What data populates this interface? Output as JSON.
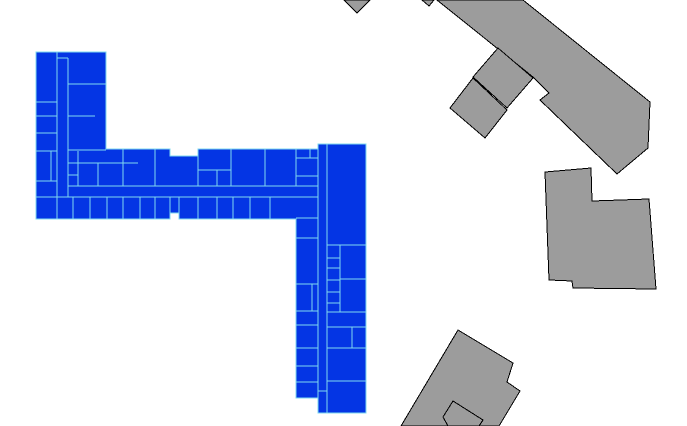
{
  "canvas": {
    "width": 687,
    "height": 426,
    "background": "#ffffff"
  },
  "selected_building": {
    "name": "selected-building",
    "fill": "#0435e4",
    "wall_color": "#7fd9ef",
    "wall_width": 1.3,
    "outline": [
      [
        36,
        52
      ],
      [
        106,
        52
      ],
      [
        106,
        149
      ],
      [
        170,
        149
      ],
      [
        170,
        156
      ],
      [
        198,
        156
      ],
      [
        198,
        149
      ],
      [
        318,
        149
      ],
      [
        318,
        144
      ],
      [
        366,
        144
      ],
      [
        366,
        413
      ],
      [
        318,
        413
      ],
      [
        318,
        398
      ],
      [
        296,
        398
      ],
      [
        296,
        219
      ],
      [
        179,
        219
      ],
      [
        179,
        213
      ],
      [
        170,
        213
      ],
      [
        170,
        219
      ],
      [
        36,
        219
      ]
    ],
    "walls": [
      [
        57,
        52,
        57,
        219
      ],
      [
        68,
        58,
        68,
        197
      ],
      [
        57,
        58,
        68,
        58
      ],
      [
        68,
        84,
        106,
        84
      ],
      [
        68,
        116,
        95,
        116
      ],
      [
        68,
        150,
        106,
        150
      ],
      [
        36,
        102,
        57,
        102
      ],
      [
        36,
        116,
        57,
        116
      ],
      [
        36,
        133,
        57,
        133
      ],
      [
        36,
        151,
        57,
        151
      ],
      [
        51,
        151,
        51,
        181
      ],
      [
        36,
        181,
        57,
        181
      ],
      [
        78,
        151,
        78,
        186
      ],
      [
        68,
        163,
        78,
        163
      ],
      [
        68,
        175,
        78,
        175
      ],
      [
        78,
        163,
        138,
        163
      ],
      [
        98,
        163,
        98,
        186
      ],
      [
        123,
        149,
        123,
        186
      ],
      [
        155,
        149,
        155,
        186
      ],
      [
        198,
        156,
        198,
        186
      ],
      [
        198,
        170,
        231,
        170
      ],
      [
        217,
        170,
        217,
        186
      ],
      [
        231,
        149,
        231,
        186
      ],
      [
        265,
        149,
        265,
        186
      ],
      [
        296,
        149,
        296,
        186
      ],
      [
        296,
        158,
        318,
        158
      ],
      [
        310,
        149,
        310,
        158
      ],
      [
        296,
        176,
        318,
        176
      ],
      [
        68,
        186,
        318,
        186
      ],
      [
        36,
        197,
        318,
        197
      ],
      [
        73,
        197,
        73,
        219
      ],
      [
        90,
        197,
        90,
        219
      ],
      [
        107,
        197,
        107,
        219
      ],
      [
        123,
        197,
        123,
        219
      ],
      [
        140,
        197,
        140,
        219
      ],
      [
        155,
        197,
        155,
        219
      ],
      [
        170,
        197,
        170,
        213
      ],
      [
        179,
        197,
        179,
        213
      ],
      [
        198,
        197,
        198,
        219
      ],
      [
        217,
        197,
        217,
        219
      ],
      [
        233,
        197,
        233,
        219
      ],
      [
        250,
        197,
        250,
        219
      ],
      [
        270,
        197,
        270,
        219
      ],
      [
        318,
        149,
        318,
        413
      ],
      [
        327,
        144,
        327,
        413
      ],
      [
        296,
        218,
        318,
        218
      ],
      [
        296,
        238,
        318,
        238
      ],
      [
        296,
        284,
        318,
        284
      ],
      [
        312,
        284,
        312,
        311
      ],
      [
        296,
        311,
        318,
        311
      ],
      [
        296,
        325,
        318,
        325
      ],
      [
        296,
        348,
        318,
        348
      ],
      [
        296,
        366,
        318,
        366
      ],
      [
        296,
        382,
        318,
        382
      ],
      [
        327,
        245,
        366,
        245
      ],
      [
        340,
        245,
        340,
        312
      ],
      [
        327,
        258,
        340,
        258
      ],
      [
        327,
        268,
        340,
        268
      ],
      [
        327,
        280,
        340,
        280
      ],
      [
        327,
        292,
        340,
        292
      ],
      [
        327,
        303,
        340,
        303
      ],
      [
        340,
        279,
        366,
        279
      ],
      [
        327,
        312,
        366,
        312
      ],
      [
        327,
        327,
        366,
        327
      ],
      [
        352,
        327,
        352,
        348
      ],
      [
        327,
        348,
        366,
        348
      ],
      [
        327,
        381,
        366,
        381
      ],
      [
        318,
        391,
        327,
        391
      ]
    ]
  },
  "context_buildings": {
    "fill": "#9c9c9c",
    "stroke": "#000000",
    "stroke_width": 1,
    "polygons": [
      {
        "name": "building-wedge-north-left",
        "points": [
          [
            344,
            0
          ],
          [
            370,
            0
          ],
          [
            357,
            13
          ]
        ]
      },
      {
        "name": "building-wedge-north-small",
        "points": [
          [
            422,
            0
          ],
          [
            434,
            0
          ],
          [
            429,
            6
          ]
        ]
      },
      {
        "name": "building-diagonal-large",
        "points": [
          [
            437,
            0
          ],
          [
            523,
            0
          ],
          [
            650,
            102
          ],
          [
            648,
            148
          ],
          [
            617,
            174
          ],
          [
            540,
            100
          ],
          [
            549,
            93
          ],
          [
            533,
            77
          ]
        ]
      },
      {
        "name": "building-quad-upper",
        "points": [
          [
            498,
            48
          ],
          [
            533,
            78
          ],
          [
            507,
            108
          ],
          [
            473,
            77
          ]
        ]
      },
      {
        "name": "building-quad-lower",
        "points": [
          [
            473,
            78
          ],
          [
            507,
            110
          ],
          [
            485,
            138
          ],
          [
            450,
            108
          ]
        ]
      },
      {
        "name": "building-block-east",
        "points": [
          [
            545,
            172
          ],
          [
            591,
            168
          ],
          [
            592,
            201
          ],
          [
            649,
            199
          ],
          [
            656,
            289
          ],
          [
            573,
            288
          ],
          [
            572,
            281
          ],
          [
            549,
            280
          ]
        ]
      },
      {
        "name": "building-tilted-south",
        "points": [
          [
            458,
            330
          ],
          [
            513,
            363
          ],
          [
            507,
            382
          ],
          [
            520,
            391
          ],
          [
            499,
            426
          ],
          [
            401,
            426
          ]
        ]
      },
      {
        "name": "building-annex-south",
        "points": [
          [
            453,
            401
          ],
          [
            483,
            420
          ],
          [
            479,
            426
          ],
          [
            448,
            426
          ],
          [
            443,
            417
          ]
        ]
      }
    ]
  }
}
